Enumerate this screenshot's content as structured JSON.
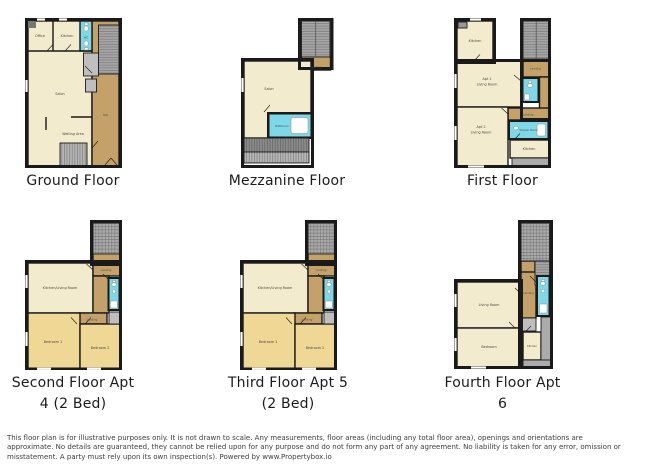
{
  "plans": {
    "ground": {
      "title": "Ground Floor",
      "rooms": {
        "office": "Office",
        "kitchen": "Kitchen",
        "wc": "WC",
        "salon": "Salon",
        "hall": "Hall",
        "waiting_area": "Waiting Area"
      }
    },
    "mezzanine": {
      "title": "Mezzanine Floor",
      "rooms": {
        "salon": "Salon",
        "landing": "Landing",
        "bathroom": "Bathroom"
      }
    },
    "first": {
      "title": "First Floor",
      "rooms": {
        "kitchen_apt1": "Kitchen",
        "apt1_line1": "Apt 1",
        "apt1_line2": "Living Room",
        "landing_upper": "Landing",
        "landing_lower": "Landing",
        "apt2_line1": "Apt 2",
        "apt2_line2": "Living Room",
        "shower_room": "Shower Room",
        "kitchen_apt2": "Kitchen"
      }
    },
    "second": {
      "title_line1": "Second Floor Apt",
      "title_line2": "4 (2 Bed)",
      "rooms": {
        "kitchen_living": "Kitchen/Living Room",
        "landing_upper": "Landing",
        "landing_lower": "Landing",
        "bedroom1": "Bedroom 1",
        "bedroom2": "Bedroom 2"
      }
    },
    "third": {
      "title_line1": "Third Floor Apt 5",
      "title_line2": "(2 Bed)",
      "rooms": {
        "kitchen_living": "Kitchen/Living Room",
        "landing_upper": "Landing",
        "landing_lower": "Landing",
        "bedroom1": "Bedroom 1",
        "bedroom2": "Bedroom 2"
      }
    },
    "fourth": {
      "title": "Fourth Floor Apt 6",
      "rooms": {
        "living_room": "Living Room",
        "landing": "Landing",
        "bedroom": "Bedroom",
        "kitchen": "Kitchen"
      }
    }
  },
  "colors": {
    "room_cream": "#F3EBCD",
    "bedroom_gold": "#EFD795",
    "hall_tan": "#C3A169",
    "bathroom_blue": "#7ED8E8",
    "stairs_gray": "#ABABAB",
    "wall_black": "#1A1A1A"
  },
  "disclaimer": {
    "lines": [
      "This floor plan is for illustrative purposes only. It is not drawn to scale. Any measurements, floor areas (including any total floor area), openings and orientations are",
      "approximate. No details are guaranteed, they cannot be relied upon for any purpose and do not form any part of any agreement. No liability is taken for any error, omission or",
      "misstatement. A party must rely upon its own inspection(s). Powered by www.Propertybox.io"
    ]
  }
}
